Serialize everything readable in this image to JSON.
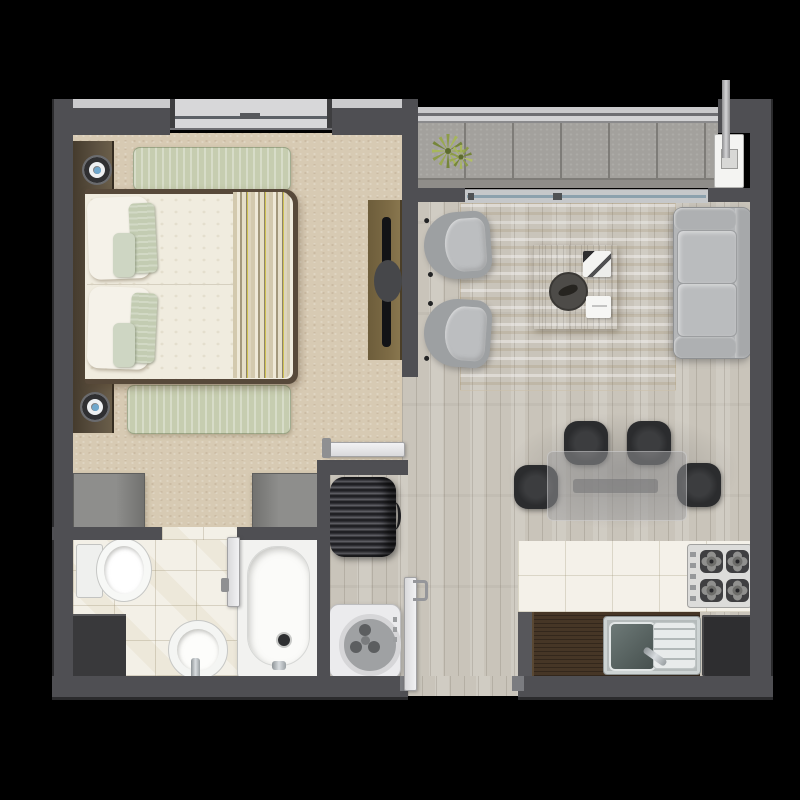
{
  "scene": {
    "type": "apartment-floor-plan-top-view",
    "title": "One-bedroom apartment floor plan (rendered, no text labels)",
    "rooms": [
      {
        "id": "bedroom",
        "name": "Bedroom",
        "floor": "beige carpet",
        "items": [
          "double-bed",
          "headboard-panel",
          "2 bedside lamps",
          "green rug (head strip)",
          "green rug (foot strip)",
          "wardrobe-left",
          "wardrobe-right",
          "tv-console",
          "tv",
          "swing door"
        ]
      },
      {
        "id": "living-room",
        "name": "Living room",
        "floor": "light wood planks",
        "items": [
          "2 barrel armchairs",
          "striped cream rug",
          "wood coffee table with tray, book and card",
          "3-seat gray sofa"
        ]
      },
      {
        "id": "dining-area",
        "name": "Dining area",
        "floor": "light wood planks",
        "items": [
          "glass dining table",
          "4 black chairs"
        ]
      },
      {
        "id": "kitchen",
        "name": "Kitchen",
        "floor": "white ceramic tiles",
        "items": [
          "4-burner gas cooktop",
          "dark wood counter",
          "stainless double sink",
          "end cabinet"
        ]
      },
      {
        "id": "bathroom",
        "name": "Bathroom",
        "floor": "white tiles",
        "items": [
          "toilet",
          "pedestal basin",
          "bathtub",
          "corner counter",
          "swing door"
        ]
      },
      {
        "id": "laundry",
        "name": "Laundry nook",
        "floor": "light wood planks",
        "items": [
          "water heater tank",
          "top-load washing machine"
        ]
      },
      {
        "id": "balcony",
        "name": "Balcony",
        "floor": "gray stone tiles",
        "items": [
          "potted plant",
          "utility unit with vent pipe",
          "railing",
          "sliding glass door"
        ]
      },
      {
        "id": "entry",
        "name": "Entry corridor",
        "floor": "light wood planks",
        "items": [
          "entry swing door"
        ]
      }
    ],
    "counts": {
      "dining_chairs": 4,
      "stove_burners": 4,
      "bed_pillows": 2,
      "accent_pillows": 4,
      "armchairs": 2,
      "lamps": 2
    },
    "colors": {
      "bg": "#000000",
      "wall": "#4f4f53",
      "wallEdge": "#2b2b2d",
      "wallLight": "#cbcbcd",
      "carpet": "#d7cab3",
      "wood": "#c9c4ba",
      "bathTile": "#f3f0e7",
      "kitchenTile": "#f4f1e9",
      "balconyTile": "#a3a19d",
      "rugGreen": "#c6cdb0",
      "duvet": "#f0ecdf",
      "headboard": "#5b5040",
      "consoleWood": "#7d6b45",
      "tableWood": "#8d6f45",
      "counterWood": "#463626",
      "sofa": "#b4b6b8",
      "chairDark": "#2b2c2e",
      "washer": "#ebebed",
      "glass": "rgba(155,155,157,0.5)",
      "plant": "#93a24c"
    }
  }
}
